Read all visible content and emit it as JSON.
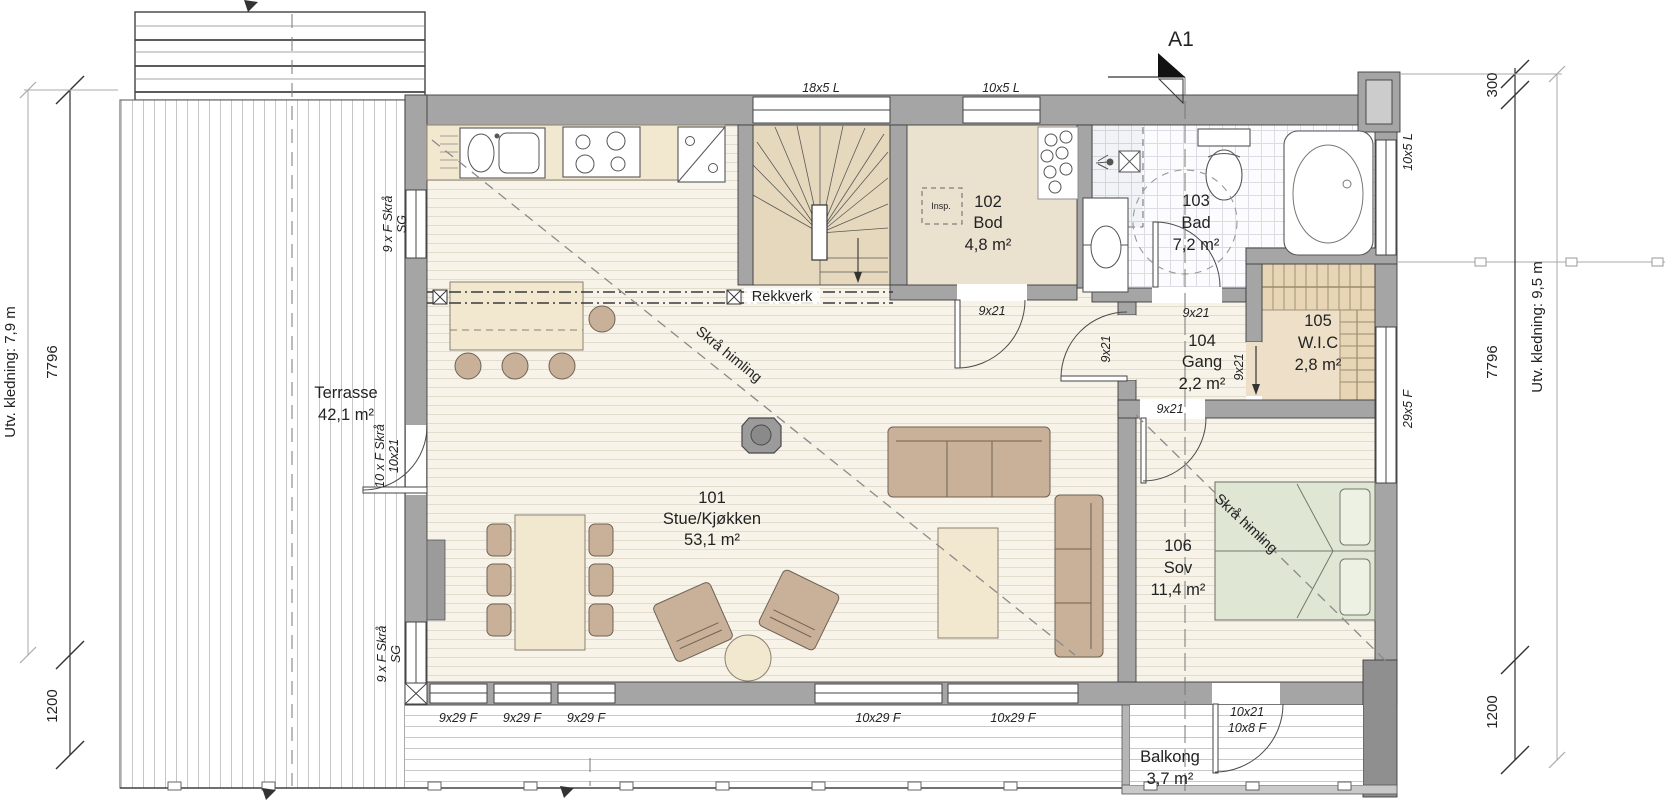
{
  "marker": {
    "a1": "A1"
  },
  "rooms": {
    "stue": {
      "id": "101",
      "name": "Stue/Kjøkken",
      "area": "53,1 m²"
    },
    "bod": {
      "id": "102",
      "name": "Bod",
      "area": "4,8 m²"
    },
    "bad": {
      "id": "103",
      "name": "Bad",
      "area": "7,2 m²"
    },
    "gang": {
      "id": "104",
      "name": "Gang",
      "area": "2,2 m²"
    },
    "wic": {
      "id": "105",
      "name": "W.I.C",
      "area": "2,8 m²"
    },
    "sov": {
      "id": "106",
      "name": "Sov",
      "area": "11,4 m²"
    },
    "terrasse": {
      "name": "Terrasse",
      "area": "42,1 m²"
    },
    "balkong": {
      "name": "Balkong",
      "area": "3,7 m²"
    }
  },
  "openings": {
    "win_18x5": "18x5 L",
    "win_10x5": "10x5 L",
    "win_29x5": "29x5 F",
    "win_9x29": "9x29 F",
    "win_10x29": "10x29 F",
    "door_9x21": "9x21",
    "door_10x21": "10x21",
    "door_10x8": "10x8 F",
    "skra_9": "9 x F Skrå",
    "skra_10": "10 x F Skrå",
    "sg": "SG"
  },
  "annotations": {
    "rekkverk": "Rekkverk",
    "skra_himling": "Skrå himling",
    "insp": "Insp."
  },
  "dimensions": {
    "left_cladding": "Utv. kledning: 7,9 m",
    "right_cladding": "Utv. kledning: 9,5 m",
    "d7796": "7796",
    "d1200": "1200",
    "d300": "300"
  },
  "colors": {
    "wall": "#a5a5a5",
    "floor": "#f7f3e9",
    "bod_floor": "#ebe1cf",
    "stair": "#e6d8bd",
    "wardrobe": "#e7d5b5",
    "furniture": "#c9b199",
    "bed": "#e0e6d4",
    "tile": "#fcfcfe"
  }
}
